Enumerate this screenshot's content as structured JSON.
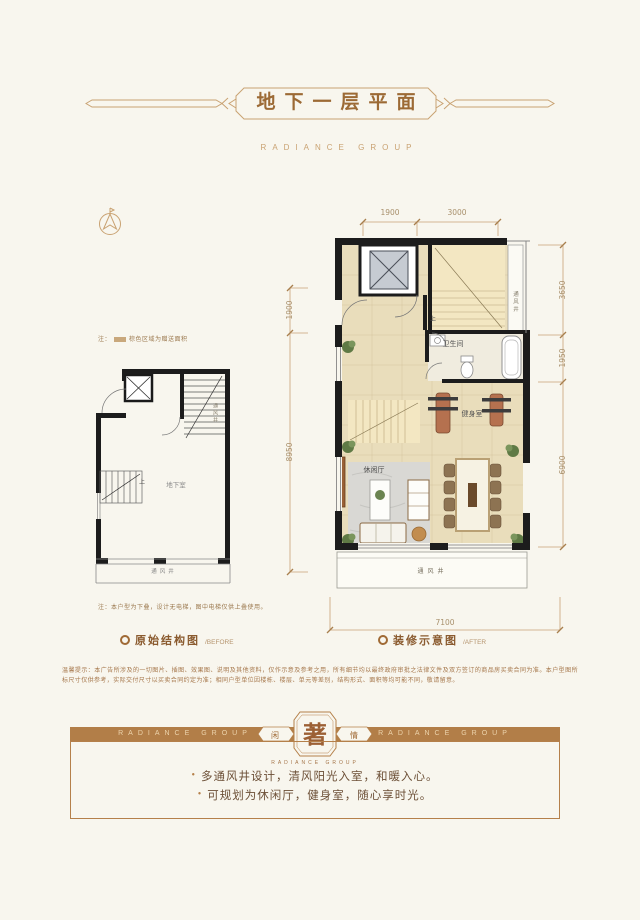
{
  "header": {
    "title": "地下一层平面",
    "subtitle": "RADIANCE GROUP"
  },
  "before": {
    "note_top_prefix": "注：",
    "note_top_text": "棕色区域为赠送面积",
    "note_bottom": "注：本户型为下叠，设计无电梯，图中电梯仅供上叠使用。",
    "legend_label": "原始结构图",
    "legend_suffix": "/BEFORE",
    "labels": {
      "vent_right": "通风井",
      "room": "地下室",
      "vent_bottom": "通风井",
      "up": "上"
    }
  },
  "after": {
    "legend_label": "装修示意图",
    "legend_suffix": "/AFTER",
    "labels": {
      "vent_right": "通风井",
      "bathroom": "卫生间",
      "gym": "健身室",
      "lounge": "休闲厅",
      "vent_bottom": "通风井",
      "up": "上"
    },
    "dims": {
      "top": [
        "1900",
        "3000"
      ],
      "left": [
        "1900",
        "8950"
      ],
      "right": [
        "3650",
        "1950",
        "6900"
      ],
      "bottom": "7100"
    }
  },
  "disclaimer": "温馨提示：本广告所涉及的一切图片、插图、效果图、说明及其他资料，仅作示意及参考之用，所有细节均以最终政府审批之法律文件及双方签订的商品房买卖合同为准。本户型图所标尺寸仅供参考，实际交付尺寸以买卖合同约定为准；相同户型单位因楼栋、楼层、单元等差别，结构形式、面积等均可能不同，敬请留意。",
  "footer": {
    "brand_left": "RADIANCE GROUP",
    "brand_right": "RADIANCE GROUP",
    "seal_left": "闲",
    "seal_center": "著",
    "seal_right": "情",
    "seal_subtitle": "RADIANCE GROUP",
    "bullets": [
      "多通风井设计，清风阳光入室，和暖入心。",
      "可规划为休闲厅，健身室，随心享时光。"
    ]
  },
  "colors": {
    "accent": "#b5804a",
    "ornament": "#c9a272",
    "title": "#9c6a35"
  }
}
